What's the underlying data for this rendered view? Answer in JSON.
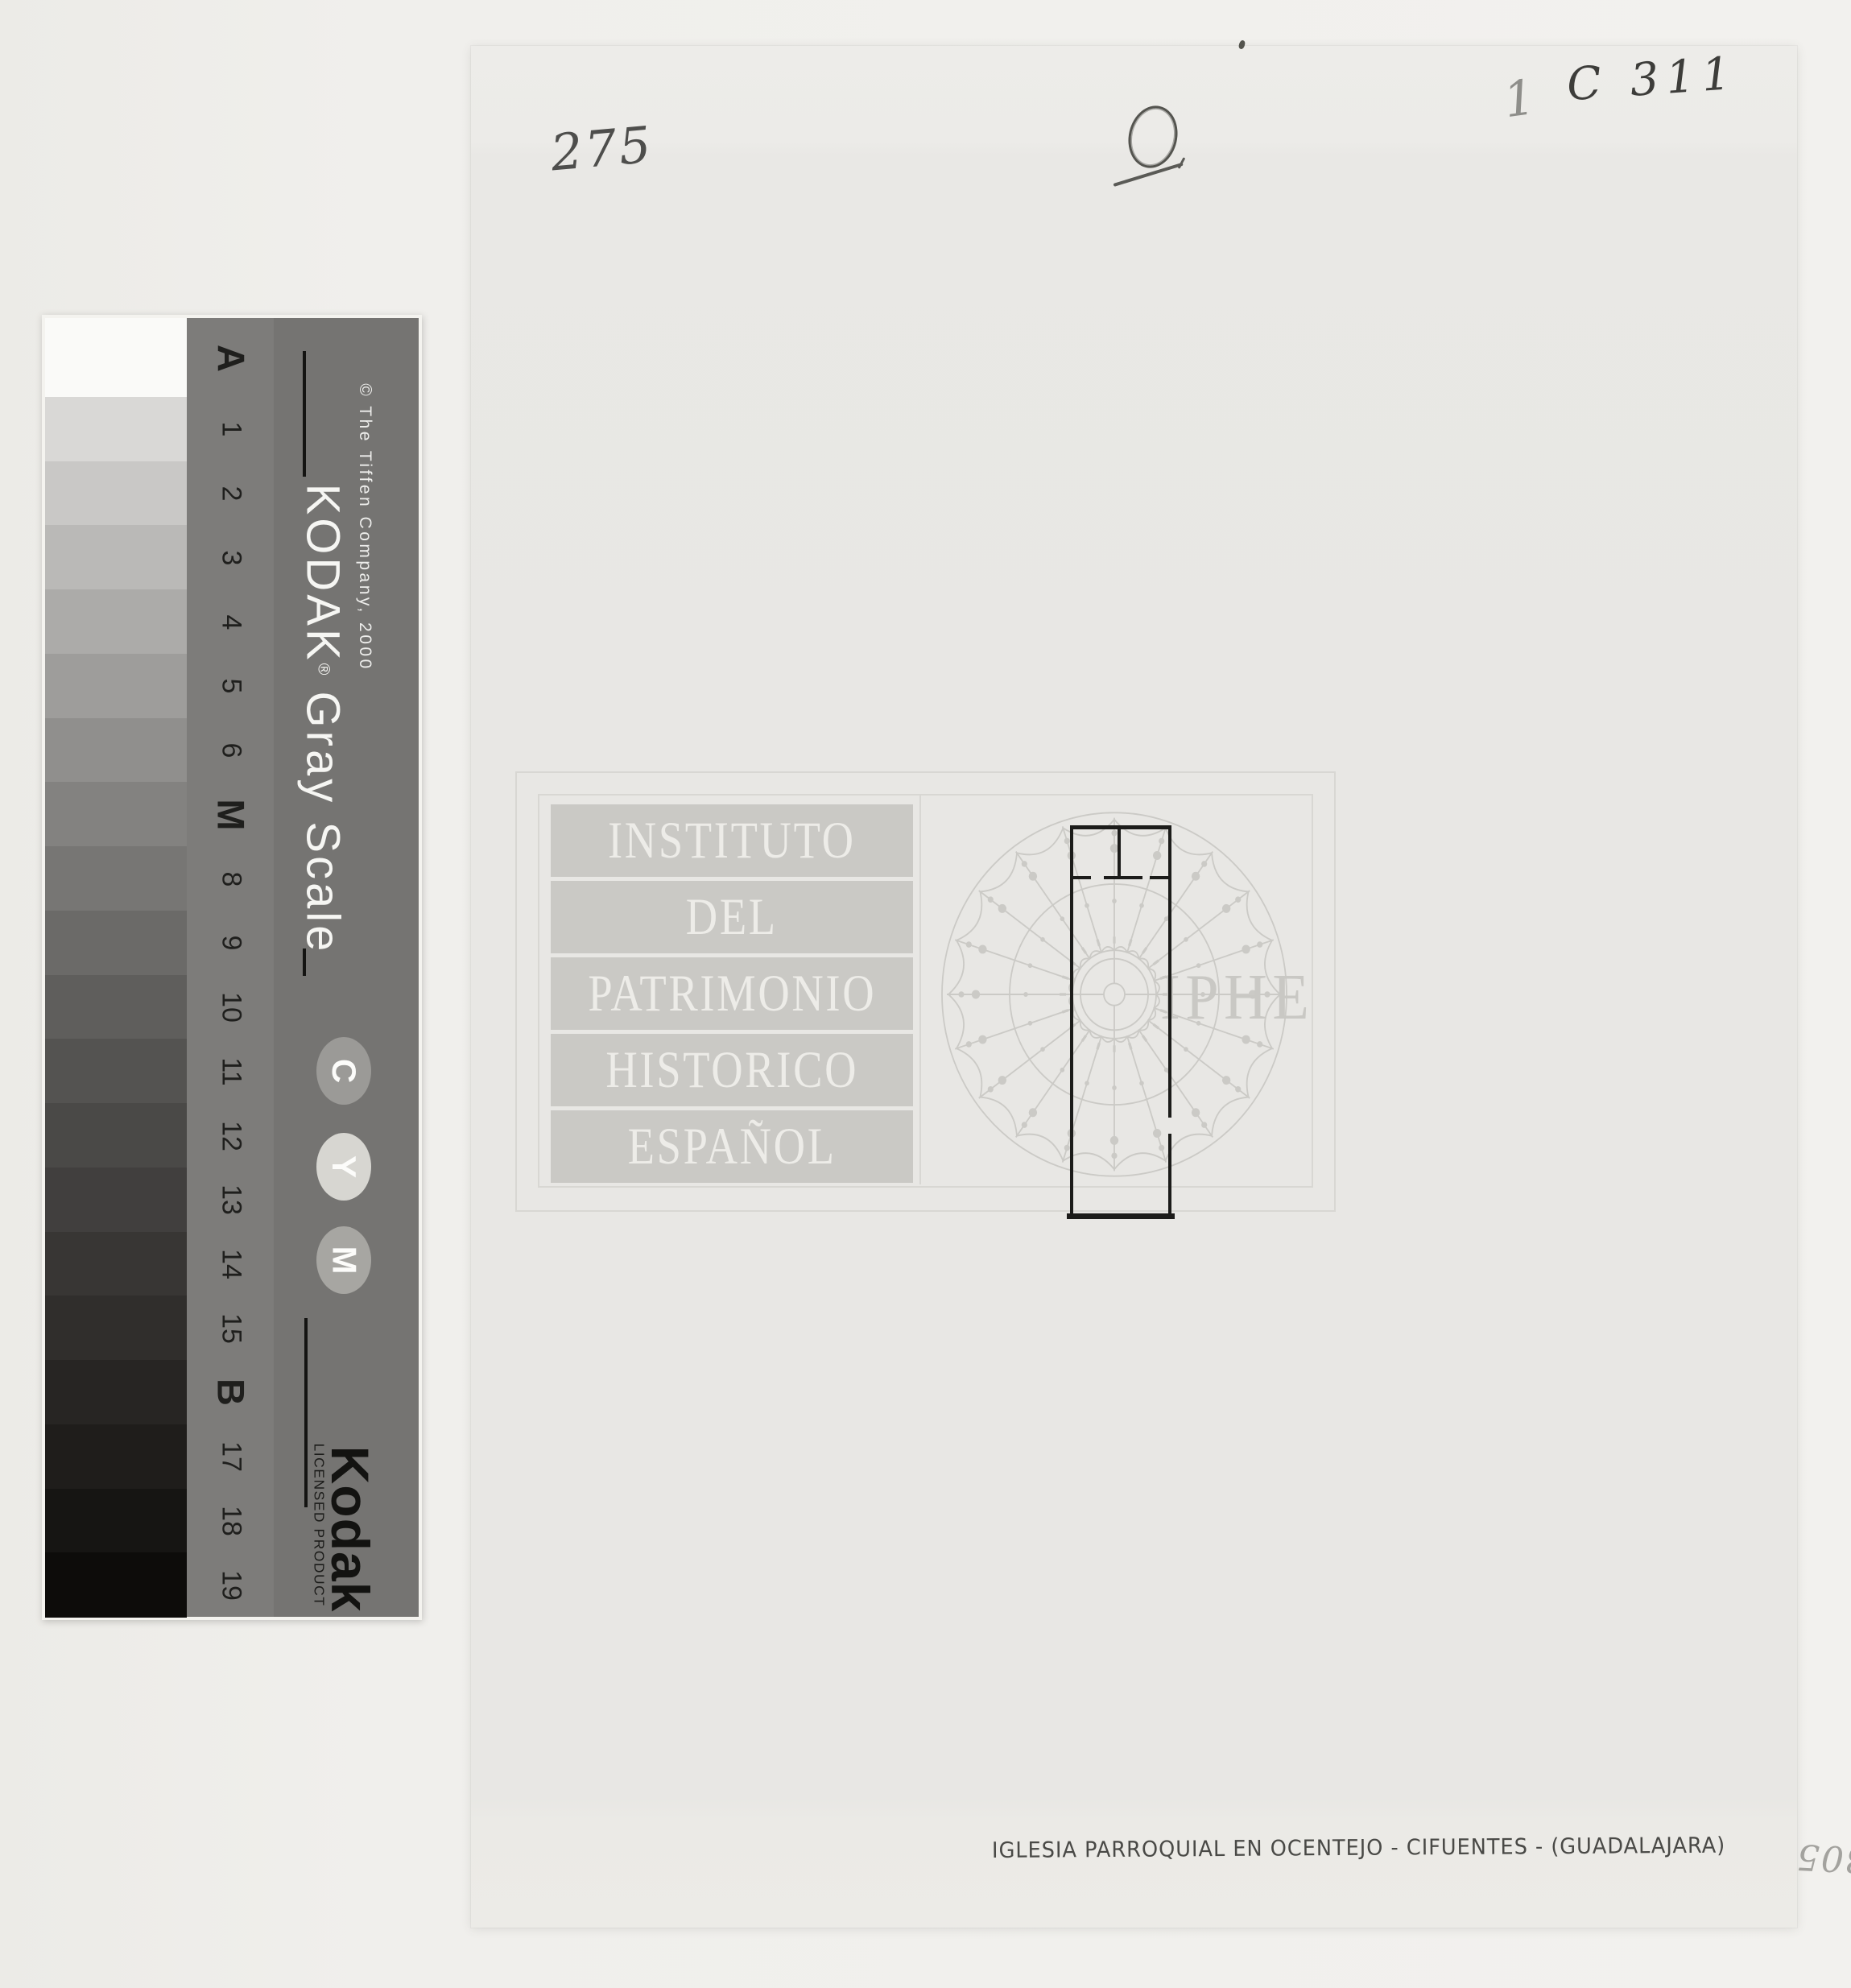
{
  "document": {
    "marks": {
      "top_left_number": "275",
      "circled_number": "0",
      "top_right_prefix": "1",
      "top_right_code": "C 311",
      "bottom_right_number": "305"
    },
    "caption": "IGLESIA PARROQUIAL EN OCENTEJO - CIFUENTES - (GUADALAJARA)"
  },
  "watermark": {
    "lines": [
      "INSTITUTO",
      "DEL",
      "PATRIMONIO",
      "HISTORICO",
      "ESPAÑOL"
    ],
    "acronym": "IPHE",
    "color": "#cac9c5"
  },
  "kodak_card": {
    "title_brand": "KODAK",
    "title_reg": "®",
    "title_rest": "Gray Scale",
    "copyright": "© The Tiffen Company, 2000",
    "logo": "Kodak",
    "licensed_label": "LICENSED PRODUCT",
    "colors": {
      "band_bg": "#7d7c7a",
      "section_bg": "#757472",
      "card_edge": "#f4f3ef",
      "label_ink": "#1f1f1d"
    },
    "cym": [
      {
        "letter": "C",
        "oval_color": "#9b9a97"
      },
      {
        "letter": "Y",
        "oval_color": "#d7d6d1"
      },
      {
        "letter": "M",
        "oval_color": "#a7a6a2"
      }
    ],
    "steps": [
      {
        "label": "A",
        "bold": true,
        "shade": "#fafaf8"
      },
      {
        "label": "1",
        "bold": false,
        "shade": "#d9d8d6"
      },
      {
        "label": "2",
        "bold": false,
        "shade": "#c9c8c6"
      },
      {
        "label": "3",
        "bold": false,
        "shade": "#bab9b7"
      },
      {
        "label": "4",
        "bold": false,
        "shade": "#acaba9"
      },
      {
        "label": "5",
        "bold": false,
        "shade": "#9e9d9b"
      },
      {
        "label": "6",
        "bold": false,
        "shade": "#908f8d"
      },
      {
        "label": "M",
        "bold": true,
        "shade": "#838280"
      },
      {
        "label": "8",
        "bold": false,
        "shade": "#777674"
      },
      {
        "label": "9",
        "bold": false,
        "shade": "#6b6a68"
      },
      {
        "label": "10",
        "bold": false,
        "shade": "#5f5e5c"
      },
      {
        "label": "11",
        "bold": false,
        "shade": "#545351"
      },
      {
        "label": "12",
        "bold": false,
        "shade": "#4a4947"
      },
      {
        "label": "13",
        "bold": false,
        "shade": "#413f3e"
      },
      {
        "label": "14",
        "bold": false,
        "shade": "#383634"
      },
      {
        "label": "15",
        "bold": false,
        "shade": "#302e2c"
      },
      {
        "label": "B",
        "bold": true,
        "shade": "#272523"
      },
      {
        "label": "17",
        "bold": false,
        "shade": "#1f1d1b"
      },
      {
        "label": "18",
        "bold": false,
        "shade": "#161513"
      },
      {
        "label": "19",
        "bold": false,
        "shade": "#0d0c0a"
      }
    ]
  }
}
